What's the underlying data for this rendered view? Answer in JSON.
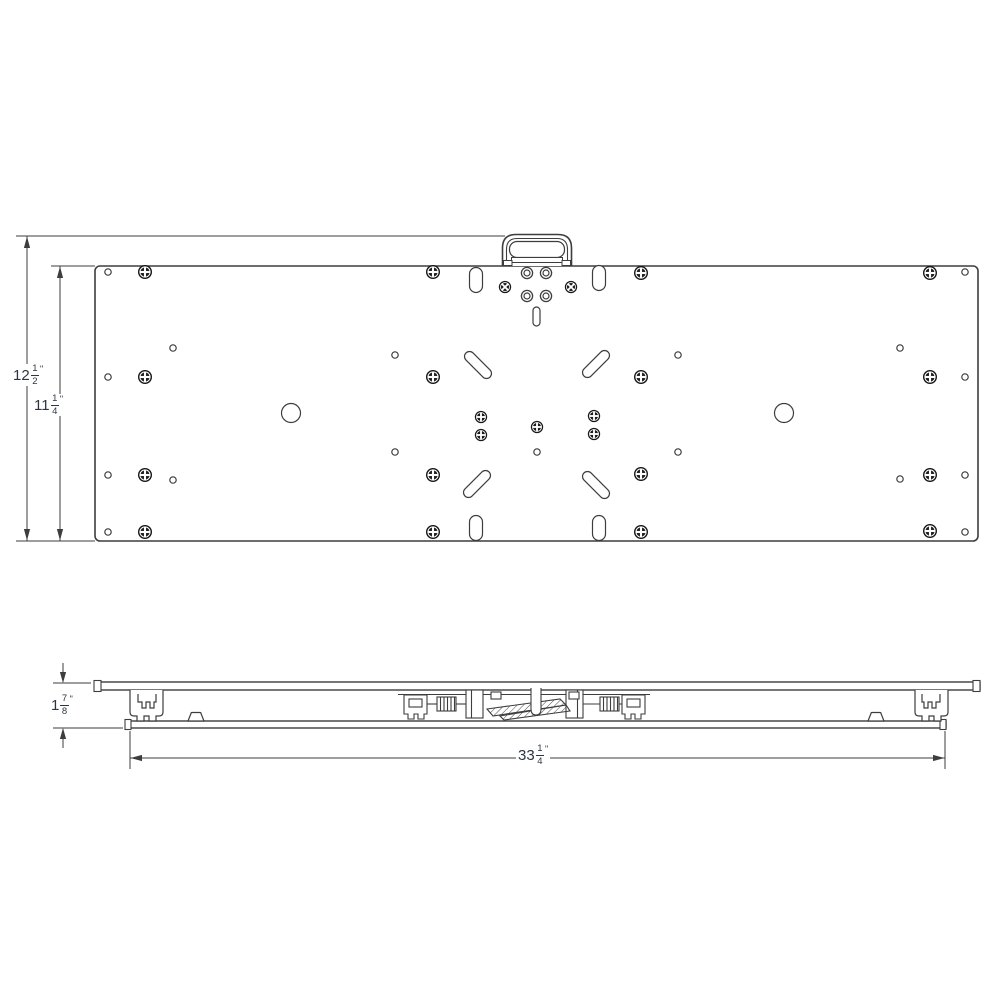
{
  "drawing": {
    "colors": {
      "line": "#3d3d3d",
      "screw": "#161616",
      "text": "#2e3542",
      "background": "#ffffff"
    },
    "dimensions": [
      {
        "id": "overall-height",
        "whole": "12",
        "num": "1",
        "den": "2",
        "unit": "\"",
        "value_inches": 12.5
      },
      {
        "id": "plate-height",
        "whole": "11",
        "num": "1",
        "den": "4",
        "unit": "\"",
        "value_inches": 11.25
      },
      {
        "id": "profile-height",
        "whole": "1",
        "num": "7",
        "den": "8",
        "unit": "\"",
        "value_inches": 1.875
      },
      {
        "id": "overall-width",
        "whole": "33",
        "num": "1",
        "den": "4",
        "unit": "\"",
        "value_inches": 33.25
      }
    ]
  }
}
